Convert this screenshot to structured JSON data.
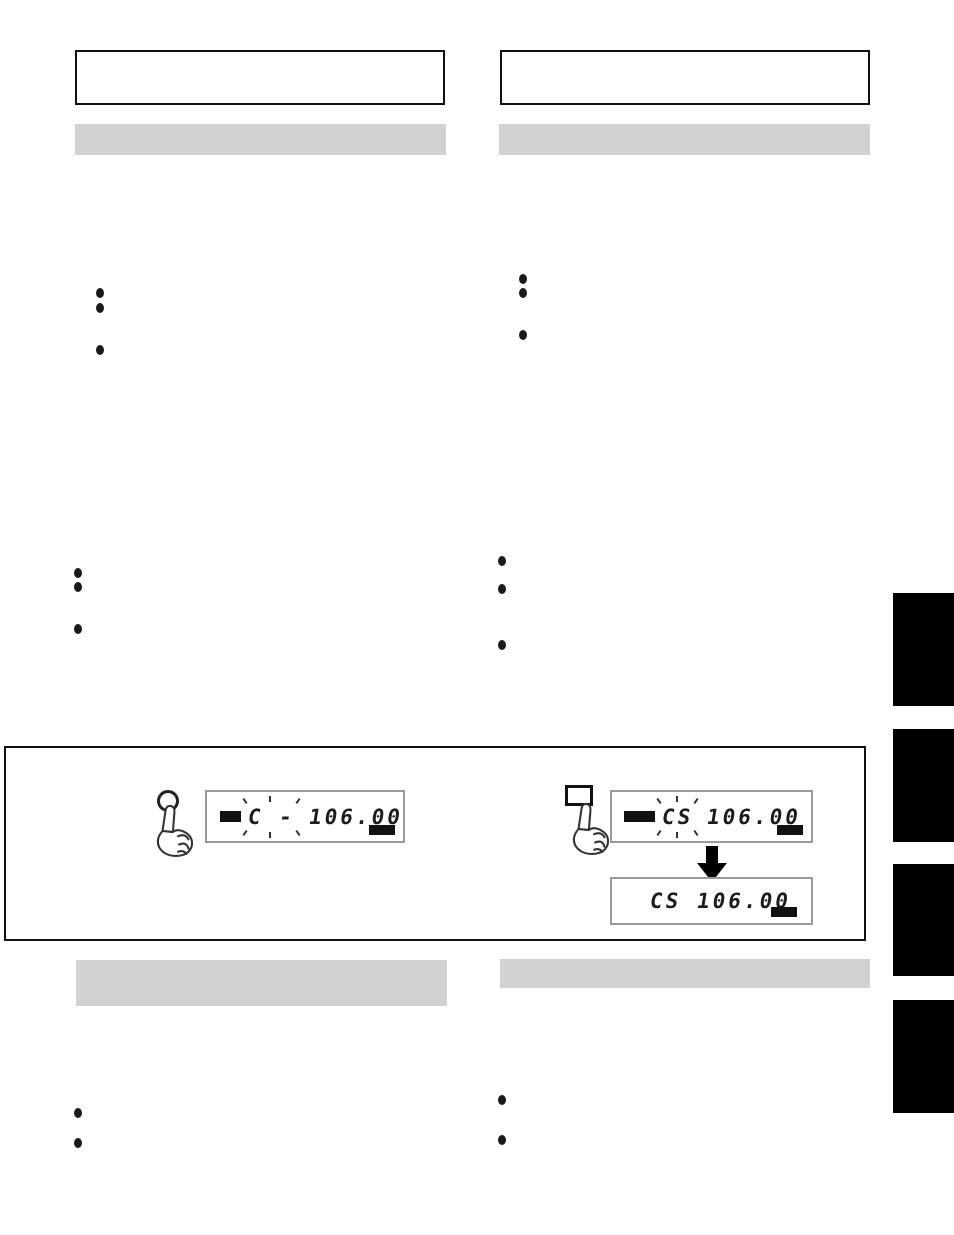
{
  "lcd_displays": {
    "step_left": {
      "blink_label": "C -",
      "frequency": "106.00"
    },
    "step_right_before": {
      "blink_label": "CS",
      "frequency": "106.00"
    },
    "step_right_after": {
      "label": "CS",
      "frequency": "106.00"
    }
  },
  "icons": {
    "press_hand": "pointing-hand-outline",
    "round_button": "circle-outline-button",
    "square_button": "square-outline-button",
    "down_arrow": "filled-down-arrow"
  },
  "colors": {
    "section_bar_gray": "#d2d2d2",
    "tab_black": "#000000",
    "lcd_border_gray": "#9a9a9a",
    "ink_black": "#111111"
  }
}
